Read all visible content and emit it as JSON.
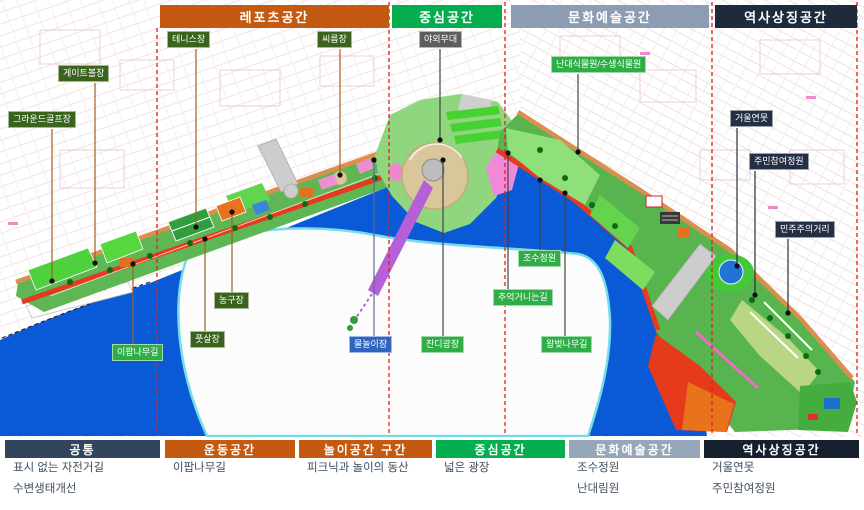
{
  "top_zones": [
    {
      "label": "레포츠공간",
      "color": "#c45911"
    },
    {
      "label": "중심공간",
      "color": "#04ad4d"
    },
    {
      "label": "문화예술공간",
      "color": "#8b9cb3"
    },
    {
      "label": "역사상징공간",
      "color": "#1d2b3c"
    }
  ],
  "map_labels": [
    {
      "id": "ground-golf",
      "text": "그라운드골프장"
    },
    {
      "id": "gateball",
      "text": "게이트볼장"
    },
    {
      "id": "tennis",
      "text": "테니스장"
    },
    {
      "id": "ssireum",
      "text": "씨름장"
    },
    {
      "id": "outdoor-stage",
      "text": "야외무대"
    },
    {
      "id": "nandae-botanic",
      "text": "난대식물원/수생식물원"
    },
    {
      "id": "mirror-pond",
      "text": "거울연못"
    },
    {
      "id": "resident-garden",
      "text": "주민참여정원"
    },
    {
      "id": "democracy-street",
      "text": "민주주의거리"
    },
    {
      "id": "tidal-garden",
      "text": "조수정원"
    },
    {
      "id": "memory-path",
      "text": "추억거니는길"
    },
    {
      "id": "cherry-road",
      "text": "왕벚나무길"
    },
    {
      "id": "water-play",
      "text": "물놀이장"
    },
    {
      "id": "lawn-plaza",
      "text": "잔디광장"
    },
    {
      "id": "basketball",
      "text": "농구장"
    },
    {
      "id": "futsal",
      "text": "풋살장"
    },
    {
      "id": "ipap-road",
      "text": "이팝나무길"
    }
  ],
  "legend": {
    "sections": [
      {
        "title": "공통",
        "color": "#31465c",
        "items": [
          "표시 없는 자전거길",
          "수변생태개선"
        ]
      },
      {
        "title": "운동공간",
        "color": "#c45911",
        "items": [
          "이팝나무길"
        ]
      },
      {
        "title": "놀이공간 구간",
        "color": "#c45911",
        "items": [
          "피크닉과 놀이의 동산"
        ]
      },
      {
        "title": "중심공간",
        "color": "#04ad4d",
        "items": [
          "넓은 광장"
        ]
      },
      {
        "title": "문화예술공간",
        "color": "#97a7ba",
        "items": [
          "조수정원",
          "난대림원"
        ]
      },
      {
        "title": "역사상징공간",
        "color": "#16202e",
        "items": [
          "거울연못",
          "주민참여정원"
        ]
      }
    ]
  },
  "colors": {
    "water": "#0a5ad8",
    "shallow_stream": "#76dde8",
    "park_green": "#57b44f",
    "promenade_red": "#e7391f",
    "city_road_orange": "#db8f4f",
    "zone_divider_red": "#e02424",
    "pier_purple": "#b55fd8",
    "amphitheater_tan": "#d9c79b"
  }
}
